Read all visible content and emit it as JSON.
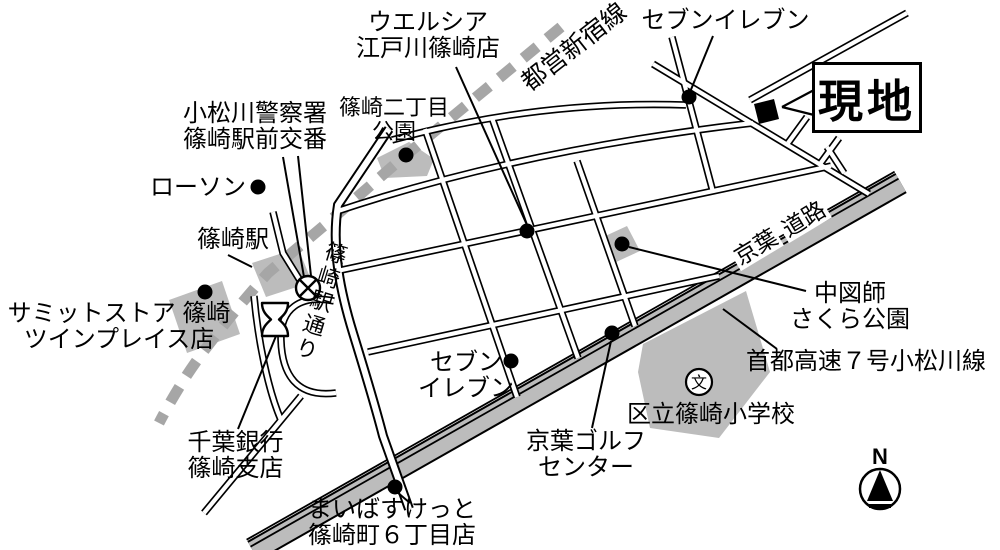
{
  "labels": {
    "welcia": [
      "ウエルシア",
      "江戸川篠崎店"
    ],
    "toei_line": "都営新宿線",
    "seven_eleven_north": "セブンイレブン",
    "genchi": "現地",
    "police": [
      "小松川警察署",
      "篠崎駅前交番"
    ],
    "nichome_park": [
      "篠崎二丁目",
      "公園"
    ],
    "lawson": "ローソン",
    "station": "篠崎駅",
    "summit": [
      "サミットストア 篠崎",
      "ツインプレイス店"
    ],
    "ekidori": "篠崎駅通り",
    "seven_eleven_south": [
      "セブン",
      "イレブン"
    ],
    "nakazushi_park": [
      "中図師",
      "さくら公園"
    ],
    "keiyo_road": [
      "京葉",
      "道路"
    ],
    "shuto_expressway": "首都高速７号小松川線",
    "school": "区立篠崎小学校",
    "school_symbol": "文",
    "golf": [
      "京葉ゴルフ",
      "センター"
    ],
    "chiba_bank": [
      "千葉銀行",
      "篠崎支店"
    ],
    "maibasket": [
      "まいばすけっと",
      "篠崎町６丁目店"
    ],
    "compass_north": "N"
  },
  "colors": {
    "line_black": "#000000",
    "area_gray": "#bcbcbc",
    "rail_gray": "#a6a6a6",
    "background": "#ffffff"
  }
}
